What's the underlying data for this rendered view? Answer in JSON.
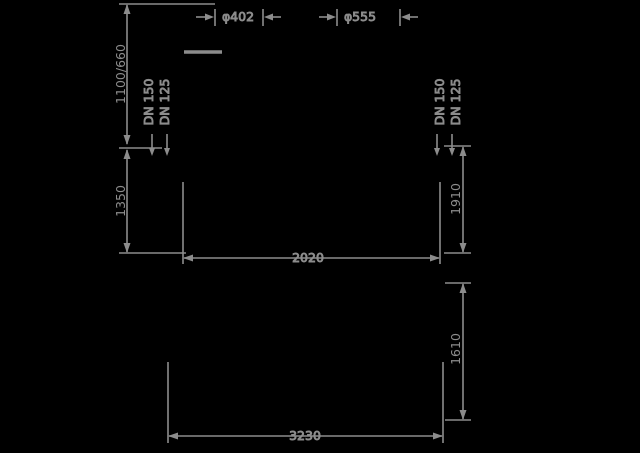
{
  "drawing": {
    "background_color": "#000000",
    "line_color": "#8c8c8c",
    "dn": [
      "DN 150",
      "DN 125"
    ],
    "top_view": {
      "height_left_upper": "1100/660",
      "height_left_lower": "1350",
      "dia_left_nozzle": "φ402",
      "dia_right_nozzle": "φ555",
      "height_right": "1910",
      "width": "2020"
    },
    "bottom_view": {
      "height_right": "1610",
      "width": "3230"
    }
  }
}
